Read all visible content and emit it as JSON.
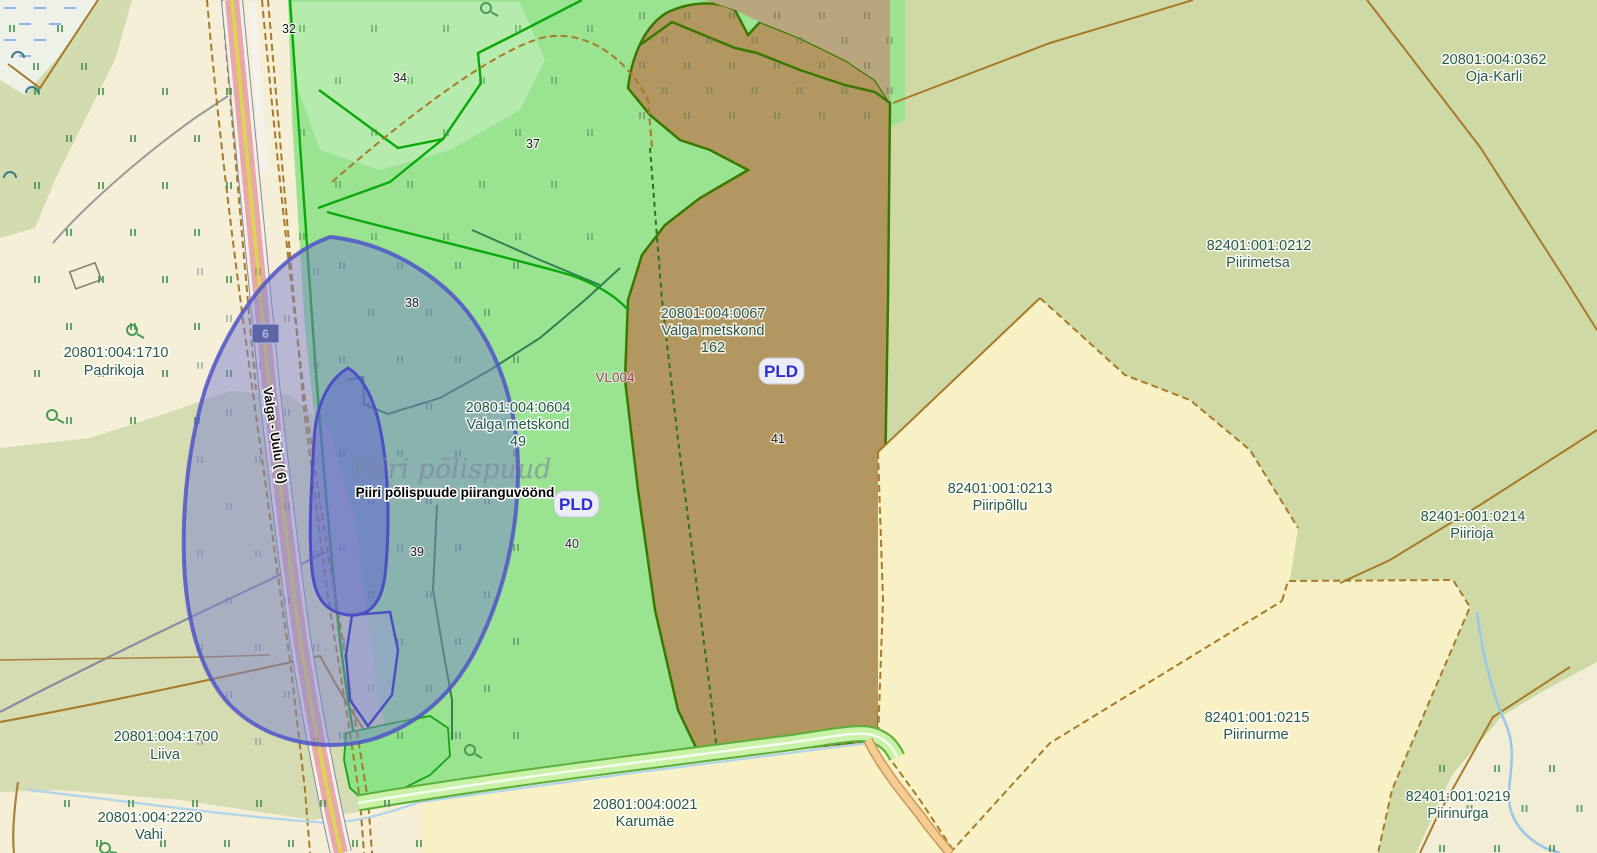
{
  "map": {
    "title": "Estonian cadastral map view",
    "road": {
      "name": "Valga - Uulu ( 6)",
      "number": "6"
    },
    "protected_object": {
      "watermark": "Piiri põlispuud",
      "zone_label": "Piiri põlispuude piiranguvöönd",
      "register_code": "VL004",
      "badge": "PLD"
    },
    "parcels": [
      {
        "code": "20801:004:1710",
        "name": "Padrikoja"
      },
      {
        "code": "20801:004:0067",
        "name": "Valga metskond",
        "extra": "162"
      },
      {
        "code": "20801:004:0604",
        "name": "Valga metskond",
        "extra": "49"
      },
      {
        "code": "20801:004:1700",
        "name": "Liiva"
      },
      {
        "code": "20801:004:2220",
        "name": "Vahi"
      },
      {
        "code": "20801:004:0021",
        "name": "Karumäe"
      },
      {
        "code": "20801:004:0362",
        "name": "Oja-Karli"
      },
      {
        "code": "82401:001:0212",
        "name": "Piirimetsa"
      },
      {
        "code": "82401:001:0213",
        "name": "Piiripõllu"
      },
      {
        "code": "82401:001:0214",
        "name": "Piirioja"
      },
      {
        "code": "82401:001:0215",
        "name": "Piirinurme"
      },
      {
        "code": "82401:001:0219",
        "name": "Piirinurga"
      }
    ],
    "forest_compartments": [
      "32",
      "34",
      "37",
      "38",
      "39",
      "40",
      "41"
    ],
    "colors": {
      "cream": "#f5efd8",
      "field_yellow": "#f9f1c6",
      "sage": "#cfd9a6",
      "forest_green": "#99e391",
      "forest_brown": "#b29760",
      "overlay_blue": "#7c82cd",
      "overlay_border": "#4f55c7",
      "road_pink": "#e8a8a8",
      "road_yellow": "#dcd64e",
      "label_green": "#2a5a49",
      "pld_blue": "#2d2dd8",
      "register_maroon": "#a03a5a"
    }
  }
}
